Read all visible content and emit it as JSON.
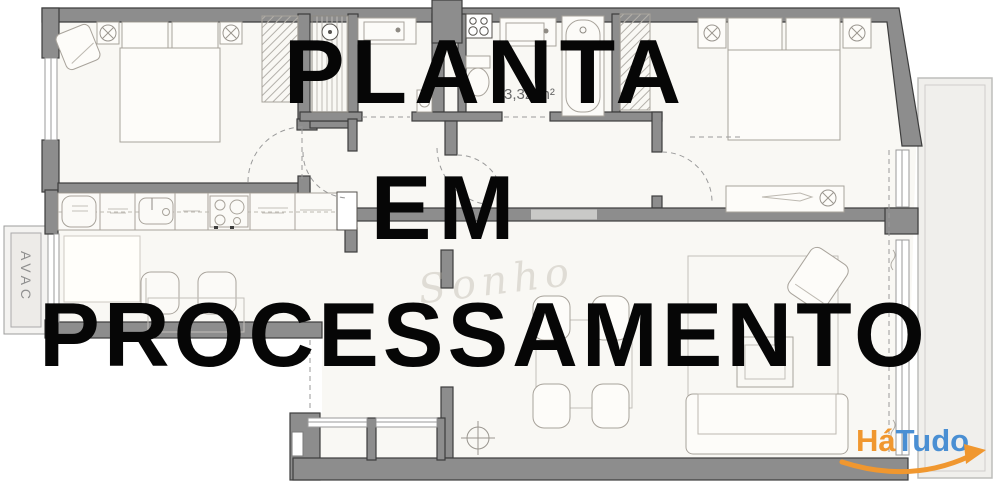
{
  "overlay": {
    "line1": "PLANTA",
    "line2": "EM",
    "line3": "PROCESSAMENTO",
    "color": "#060606"
  },
  "plan": {
    "avac_label": "AVAC",
    "area_label": "3,32 m²",
    "watermark_script": "Sonho"
  },
  "logo": {
    "part1": "Há",
    "part2": "Tudo",
    "part1_color": "#f0972f",
    "part2_color": "#4a8fd3",
    "swoosh_color": "#f0972f"
  },
  "colors": {
    "background": "#ffffff",
    "floor": "#f9f8f4",
    "wall_fill": "#8d8d8d",
    "wall_outline": "#3d3d3d",
    "furniture_line": "#a8a39b",
    "balcony_fill": "#f0efec",
    "rug_fill": "#fffefa"
  },
  "icons": {
    "wall_lamp": "circle-x-in-square",
    "ceiling_light": "circle-with-cross",
    "shower_head": "circle-with-dot",
    "stove": "four-burner-circles",
    "faucet": "small-dot"
  }
}
